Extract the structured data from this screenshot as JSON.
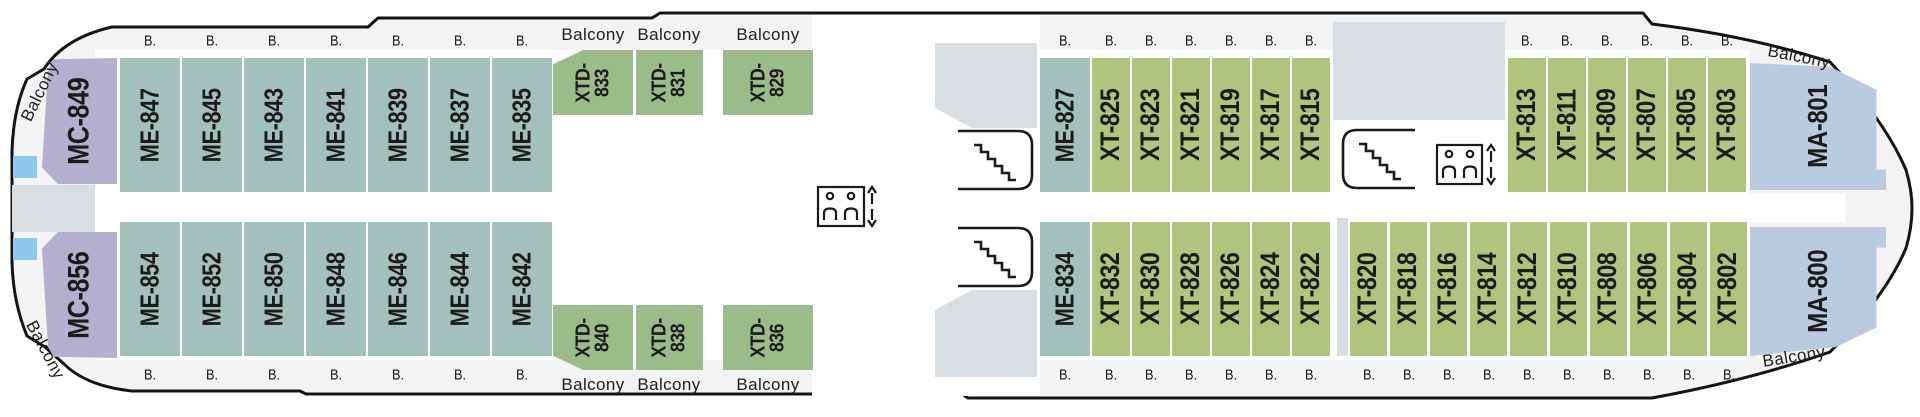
{
  "labels": {
    "balcony": "Balcony",
    "b": "B."
  },
  "colors": {
    "MC": "#b4afce",
    "ME": "#a3c0ba",
    "XTD": "#9cbb8b",
    "XT": "#b1c47e",
    "MA": "#bacbdf",
    "hull_fill": "#f2f3f5",
    "hull_line": "#141414",
    "gray_block": "#d9dee3",
    "pool_blue": "#8ec8ec",
    "text": "#1b1b1b"
  },
  "icons": {
    "stairs": "stairs-icon",
    "elevator": "elevator-icon"
  },
  "cabins": [
    {
      "id": "MC-849",
      "type": "MC",
      "row": "top",
      "x": 42,
      "y": 58,
      "w": 75,
      "h": 126,
      "shape": "mc-top"
    },
    {
      "id": "ME-847",
      "type": "ME",
      "row": "top",
      "x": 120,
      "y": 58,
      "w": 60,
      "h": 134
    },
    {
      "id": "ME-845",
      "type": "ME",
      "row": "top",
      "x": 182,
      "y": 58,
      "w": 60,
      "h": 134
    },
    {
      "id": "ME-843",
      "type": "ME",
      "row": "top",
      "x": 244,
      "y": 58,
      "w": 60,
      "h": 134
    },
    {
      "id": "ME-841",
      "type": "ME",
      "row": "top",
      "x": 306,
      "y": 58,
      "w": 60,
      "h": 134
    },
    {
      "id": "ME-839",
      "type": "ME",
      "row": "top",
      "x": 368,
      "y": 58,
      "w": 60,
      "h": 134
    },
    {
      "id": "ME-837",
      "type": "ME",
      "row": "top",
      "x": 430,
      "y": 58,
      "w": 60,
      "h": 134
    },
    {
      "id": "ME-835",
      "type": "ME",
      "row": "top",
      "x": 492,
      "y": 58,
      "w": 60,
      "h": 134
    },
    {
      "id": "XTD-833",
      "type": "XTD",
      "row": "top",
      "x": 553,
      "y": 50,
      "w": 80,
      "h": 65,
      "shape": "xtd-top"
    },
    {
      "id": "XTD-831",
      "type": "XTD",
      "row": "top",
      "x": 636,
      "y": 50,
      "w": 67,
      "h": 65
    },
    {
      "id": "XTD-829",
      "type": "XTD",
      "row": "top",
      "x": 723,
      "y": 50,
      "w": 90,
      "h": 65
    },
    {
      "id": "ME-827",
      "type": "ME",
      "row": "top",
      "x": 1040,
      "y": 58,
      "w": 50,
      "h": 134
    },
    {
      "id": "XT-825",
      "type": "XT",
      "row": "top",
      "x": 1092,
      "y": 58,
      "w": 38,
      "h": 134
    },
    {
      "id": "XT-823",
      "type": "XT",
      "row": "top",
      "x": 1132,
      "y": 58,
      "w": 38,
      "h": 134
    },
    {
      "id": "XT-821",
      "type": "XT",
      "row": "top",
      "x": 1172,
      "y": 58,
      "w": 38,
      "h": 134
    },
    {
      "id": "XT-819",
      "type": "XT",
      "row": "top",
      "x": 1212,
      "y": 58,
      "w": 38,
      "h": 134
    },
    {
      "id": "XT-817",
      "type": "XT",
      "row": "top",
      "x": 1252,
      "y": 58,
      "w": 38,
      "h": 134
    },
    {
      "id": "XT-815",
      "type": "XT",
      "row": "top",
      "x": 1292,
      "y": 58,
      "w": 38,
      "h": 134
    },
    {
      "id": "XT-813",
      "type": "XT",
      "row": "top",
      "x": 1508,
      "y": 58,
      "w": 38,
      "h": 134
    },
    {
      "id": "XT-811",
      "type": "XT",
      "row": "top",
      "x": 1548,
      "y": 58,
      "w": 38,
      "h": 134
    },
    {
      "id": "XT-809",
      "type": "XT",
      "row": "top",
      "x": 1588,
      "y": 58,
      "w": 38,
      "h": 134
    },
    {
      "id": "XT-807",
      "type": "XT",
      "row": "top",
      "x": 1628,
      "y": 58,
      "w": 38,
      "h": 134
    },
    {
      "id": "XT-805",
      "type": "XT",
      "row": "top",
      "x": 1668,
      "y": 58,
      "w": 38,
      "h": 134
    },
    {
      "id": "XT-803",
      "type": "XT",
      "row": "top",
      "x": 1708,
      "y": 58,
      "w": 38,
      "h": 134
    },
    {
      "id": "MA-801",
      "type": "MA",
      "row": "top",
      "x": 1750,
      "y": 63,
      "w": 136,
      "h": 127,
      "shape": "ma-top"
    },
    {
      "id": "MC-856",
      "type": "MC",
      "row": "bottom",
      "x": 42,
      "y": 232,
      "w": 75,
      "h": 126,
      "shape": "mc-bottom"
    },
    {
      "id": "ME-854",
      "type": "ME",
      "row": "bottom",
      "x": 120,
      "y": 222,
      "w": 60,
      "h": 134
    },
    {
      "id": "ME-852",
      "type": "ME",
      "row": "bottom",
      "x": 182,
      "y": 222,
      "w": 60,
      "h": 134
    },
    {
      "id": "ME-850",
      "type": "ME",
      "row": "bottom",
      "x": 244,
      "y": 222,
      "w": 60,
      "h": 134
    },
    {
      "id": "ME-848",
      "type": "ME",
      "row": "bottom",
      "x": 306,
      "y": 222,
      "w": 60,
      "h": 134
    },
    {
      "id": "ME-846",
      "type": "ME",
      "row": "bottom",
      "x": 368,
      "y": 222,
      "w": 60,
      "h": 134
    },
    {
      "id": "ME-844",
      "type": "ME",
      "row": "bottom",
      "x": 430,
      "y": 222,
      "w": 60,
      "h": 134
    },
    {
      "id": "ME-842",
      "type": "ME",
      "row": "bottom",
      "x": 492,
      "y": 222,
      "w": 60,
      "h": 134
    },
    {
      "id": "XTD-840",
      "type": "XTD",
      "row": "bottom",
      "x": 553,
      "y": 305,
      "w": 80,
      "h": 65,
      "shape": "xtd-bottom"
    },
    {
      "id": "XTD-838",
      "type": "XTD",
      "row": "bottom",
      "x": 636,
      "y": 305,
      "w": 67,
      "h": 65
    },
    {
      "id": "XTD-836",
      "type": "XTD",
      "row": "bottom",
      "x": 723,
      "y": 305,
      "w": 90,
      "h": 65
    },
    {
      "id": "ME-834",
      "type": "ME",
      "row": "bottom",
      "x": 1040,
      "y": 222,
      "w": 50,
      "h": 134
    },
    {
      "id": "XT-832",
      "type": "XT",
      "row": "bottom",
      "x": 1092,
      "y": 222,
      "w": 38,
      "h": 134
    },
    {
      "id": "XT-830",
      "type": "XT",
      "row": "bottom",
      "x": 1132,
      "y": 222,
      "w": 38,
      "h": 134
    },
    {
      "id": "XT-828",
      "type": "XT",
      "row": "bottom",
      "x": 1172,
      "y": 222,
      "w": 38,
      "h": 134
    },
    {
      "id": "XT-826",
      "type": "XT",
      "row": "bottom",
      "x": 1212,
      "y": 222,
      "w": 38,
      "h": 134
    },
    {
      "id": "XT-824",
      "type": "XT",
      "row": "bottom",
      "x": 1252,
      "y": 222,
      "w": 38,
      "h": 134
    },
    {
      "id": "XT-822",
      "type": "XT",
      "row": "bottom",
      "x": 1292,
      "y": 222,
      "w": 38,
      "h": 134
    },
    {
      "id": "XT-820",
      "type": "XT",
      "row": "bottom",
      "x": 1350,
      "y": 222,
      "w": 37,
      "h": 134
    },
    {
      "id": "XT-818",
      "type": "XT",
      "row": "bottom",
      "x": 1390,
      "y": 222,
      "w": 37,
      "h": 134
    },
    {
      "id": "XT-816",
      "type": "XT",
      "row": "bottom",
      "x": 1430,
      "y": 222,
      "w": 37,
      "h": 134
    },
    {
      "id": "XT-814",
      "type": "XT",
      "row": "bottom",
      "x": 1470,
      "y": 222,
      "w": 37,
      "h": 134
    },
    {
      "id": "XT-812",
      "type": "XT",
      "row": "bottom",
      "x": 1510,
      "y": 222,
      "w": 37,
      "h": 134
    },
    {
      "id": "XT-810",
      "type": "XT",
      "row": "bottom",
      "x": 1550,
      "y": 222,
      "w": 37,
      "h": 134
    },
    {
      "id": "XT-808",
      "type": "XT",
      "row": "bottom",
      "x": 1590,
      "y": 222,
      "w": 37,
      "h": 134
    },
    {
      "id": "XT-806",
      "type": "XT",
      "row": "bottom",
      "x": 1630,
      "y": 222,
      "w": 37,
      "h": 134
    },
    {
      "id": "XT-804",
      "type": "XT",
      "row": "bottom",
      "x": 1670,
      "y": 222,
      "w": 37,
      "h": 134
    },
    {
      "id": "XT-802",
      "type": "XT",
      "row": "bottom",
      "x": 1710,
      "y": 222,
      "w": 37,
      "h": 134
    },
    {
      "id": "MA-800",
      "type": "MA",
      "row": "bottom",
      "x": 1750,
      "y": 227,
      "w": 136,
      "h": 129,
      "shape": "ma-bottom"
    }
  ],
  "balcony_labels": [
    {
      "x": 593,
      "y": 35,
      "rot": 0
    },
    {
      "x": 669,
      "y": 35,
      "rot": 0
    },
    {
      "x": 768,
      "y": 35,
      "rot": 0
    },
    {
      "x": 593,
      "y": 385,
      "rot": 0
    },
    {
      "x": 669,
      "y": 385,
      "rot": 0
    },
    {
      "x": 768,
      "y": 385,
      "rot": 0
    },
    {
      "x": 1799,
      "y": 57,
      "rot": 11
    },
    {
      "x": 1794,
      "y": 357,
      "rot": -9
    },
    {
      "x": 40,
      "y": 92,
      "rot": -64
    },
    {
      "x": 45,
      "y": 350,
      "rot": 62
    }
  ]
}
